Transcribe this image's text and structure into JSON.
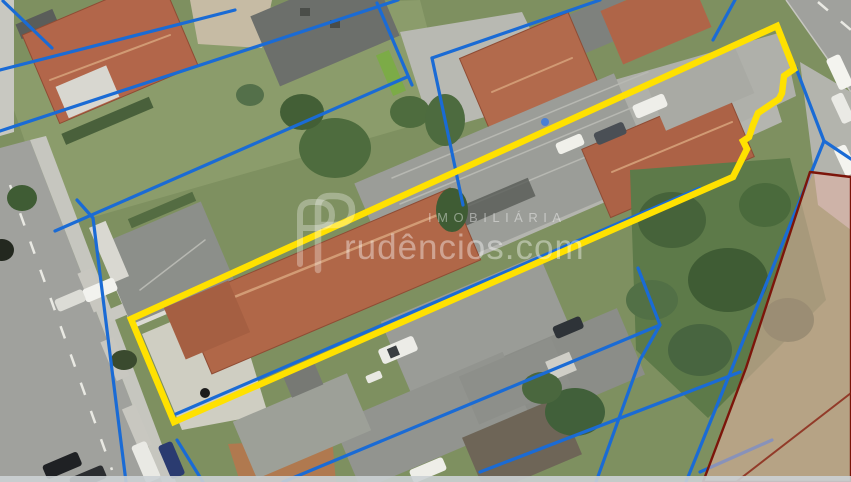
{
  "watermark": {
    "label_top": "IMOBILIÁRIA",
    "label_main": "rudêncios.com",
    "logo_letter": "P"
  },
  "colors": {
    "highlight_yellow": "#FFE100",
    "cadastral_blue": "#1A6BD5",
    "boundary_red": "#7C150A",
    "parcel_pink": "#E3B2A4",
    "watermark_white": "#FFFFFF",
    "grass_green": "#7E9060",
    "road_gray": "#A0A19D",
    "roof_terracotta": "#B2664A",
    "roof_gray": "#9B9D98"
  },
  "overlays": {
    "highlighted_parcel": {
      "points": "131,319 777,26 794,69 784,76 782,93 779,99 758,113 753,125 749,137 743,141 747,149 733,177 174,422"
    },
    "adjacent_parcel": {
      "points": "810,172 851,177 851,482 703,482 746,368",
      "inner_line": "736,482 851,393"
    },
    "cadastral_lines": {
      "segments": [
        "3,1 52,48",
        "0,70 235,10",
        "0,131 398,0",
        "377,3 412,85",
        "432,58 600,0",
        "432,58 463,205",
        "55,231 407,77",
        "77,200 93,218 126,482",
        "176,414 700,188",
        "283,482 660,325",
        "638,268 660,325 640,360 596,482",
        "824,141 686,482",
        "796,68 824,141",
        "824,141 851,159",
        "772,440 700,472",
        "177,440 203,482",
        "735,0 713,40",
        "480,472 740,372"
      ]
    }
  }
}
